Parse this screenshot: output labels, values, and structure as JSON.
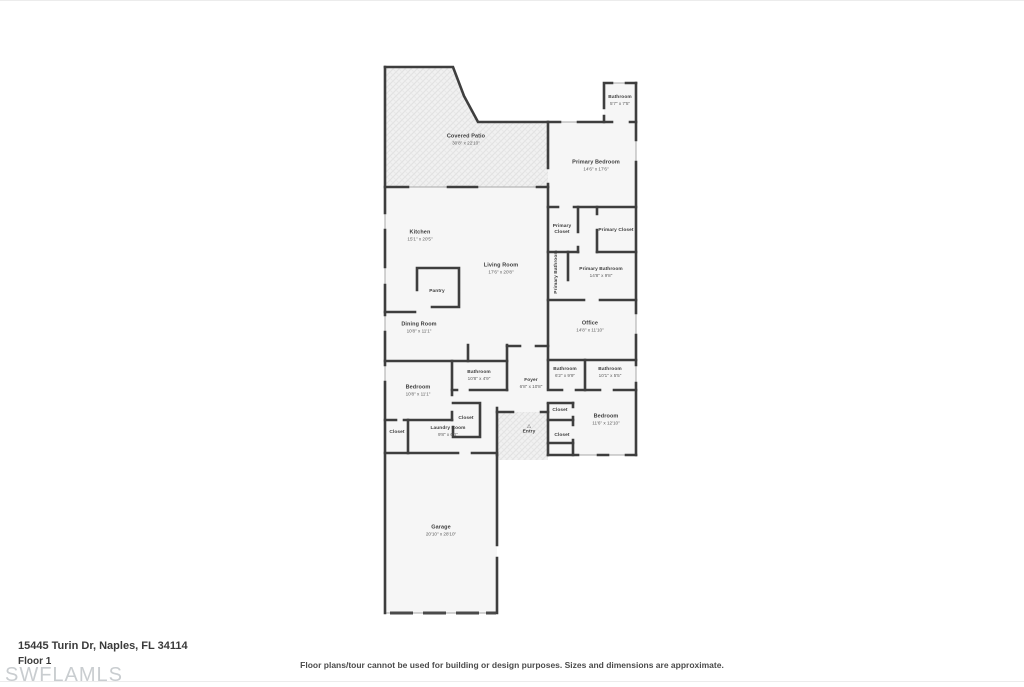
{
  "page": {
    "address": "15445 Turin Dr, Naples, FL 34114",
    "floor_label": "Floor 1",
    "watermark": "SWFLAMLS",
    "disclaimer": "Floor plans/tour cannot be used for building or design purposes. Sizes and dimensions are approximate."
  },
  "icons": {
    "entry_arrow": "△"
  },
  "rooms": {
    "covered_patio": {
      "label": "Covered Patio",
      "dims": "30'8\" x 22'10\""
    },
    "bathroom_top": {
      "label": "Bathroom",
      "dims": "5'7\" x 7'5\""
    },
    "primary_bedroom": {
      "label": "Primary Bedroom",
      "dims": "14'6\" x 17'6\""
    },
    "kitchen": {
      "label": "Kitchen",
      "dims": "15'1\" x 20'5\""
    },
    "living_room": {
      "label": "Living Room",
      "dims": "17'6\" x 20'8\""
    },
    "pantry": {
      "label": "Pantry"
    },
    "primary_closet_left": {
      "label": "Primary Closet"
    },
    "primary_closet_right": {
      "label": "Primary Closet"
    },
    "primary_bathroom_vertical": {
      "label": "Primary Bathroom"
    },
    "primary_bathroom": {
      "label": "Primary Bathroom",
      "dims": "14'8\" x 9'8\""
    },
    "office": {
      "label": "Office",
      "dims": "14'8\" x 11'10\""
    },
    "dining_room": {
      "label": "Dining Room",
      "dims": "10'8\" x 11'1\""
    },
    "bedroom_mid": {
      "label": "Bedroom",
      "dims": "10'8\" x 11'1\""
    },
    "bathroom_mid": {
      "label": "Bathroom",
      "dims": "10'8\" x 4'9\""
    },
    "foyer": {
      "label": "Foyer",
      "dims": "6'8\" x 10'8\""
    },
    "bathroom_right_a": {
      "label": "Bathroom",
      "dims": "6'2\" x 9'9\""
    },
    "bathroom_right_b": {
      "label": "Bathroom",
      "dims": "10'1\" x 5'5\""
    },
    "bedroom_br": {
      "label": "Bedroom",
      "dims": "11'6\" x 12'10\""
    },
    "closet_hall": {
      "label": "Closet"
    },
    "closet_bedroom": {
      "label": "Closet"
    },
    "closet_laundry_left": {
      "label": "Closet"
    },
    "closet_laundry_top": {
      "label": "Closet"
    },
    "laundry": {
      "label": "Laundry Room",
      "dims": "9'8\" x 6'1\""
    },
    "entry": {
      "label": "Entry"
    },
    "garage": {
      "label": "Garage",
      "dims": "20'10\" x 28'10\""
    }
  }
}
